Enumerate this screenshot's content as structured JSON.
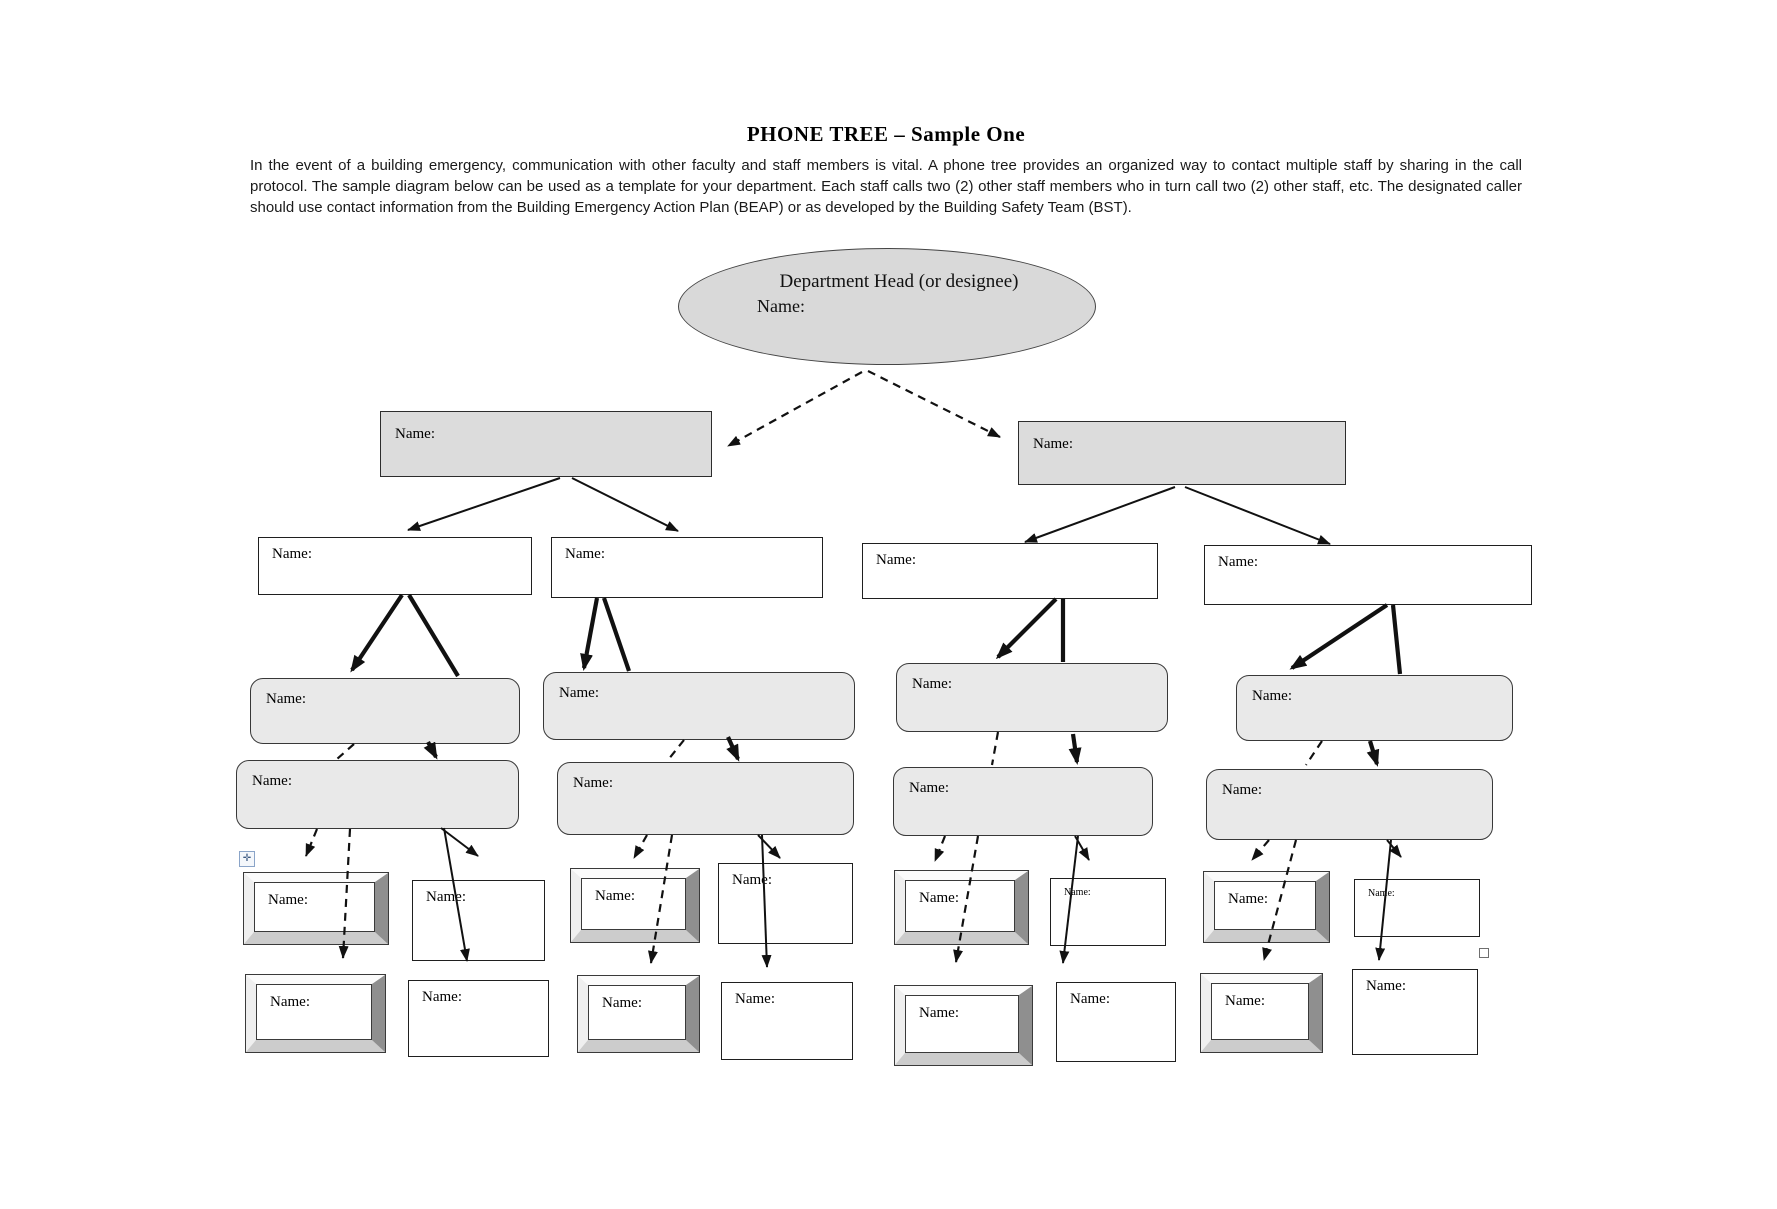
{
  "document": {
    "title": "PHONE TREE – Sample One",
    "intro": "In the event of a building emergency, communication with other faculty and staff members is vital. A phone tree provides an organized way to contact multiple staff by sharing in the call protocol. The sample diagram below can be used as a template for your department. Each staff calls two (2) other staff members who in turn call two (2) other staff, etc. The designated caller should use contact information from the Building Emergency Action Plan (BEAP) or as developed by the Building Safety Team (BST)."
  },
  "tree": {
    "root": {
      "title": "Department Head (or designee)",
      "label": "Name:"
    },
    "level1": [
      {
        "label": "Name:"
      },
      {
        "label": "Name:"
      }
    ],
    "level2": [
      {
        "label": "Name:"
      },
      {
        "label": "Name:"
      },
      {
        "label": "Name:"
      },
      {
        "label": "Name:"
      }
    ],
    "level3a": [
      {
        "label": "Name:"
      },
      {
        "label": "Name:"
      },
      {
        "label": "Name:"
      },
      {
        "label": "Name:"
      }
    ],
    "level3b": [
      {
        "label": "Name:"
      },
      {
        "label": "Name:"
      },
      {
        "label": "Name:"
      },
      {
        "label": "Name:"
      }
    ],
    "level4": [
      {
        "bevel_label": "Name:",
        "plain_label": "Name:"
      },
      {
        "bevel_label": "Name:",
        "plain_label": "Name:"
      },
      {
        "bevel_label": "Name:",
        "plain_label": "Name:"
      },
      {
        "bevel_label": "Name:",
        "plain_label": "Name:"
      }
    ],
    "level5": [
      {
        "bevel_label": "Name:",
        "plain_label": "Name:"
      },
      {
        "bevel_label": "Name:",
        "plain_label": "Name:"
      },
      {
        "bevel_label": "Name:",
        "plain_label": "Name:"
      },
      {
        "bevel_label": "Name:",
        "plain_label": "Name:"
      }
    ]
  },
  "icons": {
    "move_handle": "move-handle-icon",
    "move_handle_glyph": "✛",
    "anchor_square": "anchor-square-icon"
  },
  "colors": {
    "ellipse_fill": "#d9d9d9",
    "level1_fill": "#dcdcdc",
    "rounded_fill": "#e9e9e9",
    "stroke": "#2d2d2d",
    "arrow": "#111111"
  }
}
